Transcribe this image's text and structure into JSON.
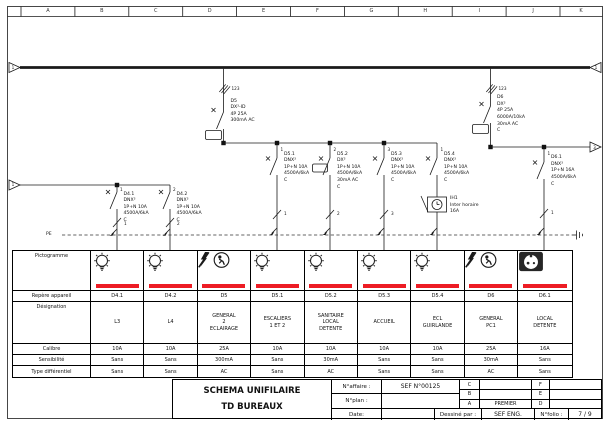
{
  "sheet": {
    "grid_letters": [
      "A",
      "B",
      "C",
      "D",
      "E",
      "F",
      "G",
      "H",
      "I",
      "J",
      "K"
    ],
    "link_markers": {
      "top_left": "1",
      "top_right": "1",
      "mid_left": "1",
      "mid_right": "3"
    },
    "pe_label": "PE"
  },
  "schematic": {
    "d5": {
      "phases": "123",
      "label": "D5\nDX³-ID\n4P 25A\n300mA AC"
    },
    "d6": {
      "phases": "123",
      "label": "D6\nDX³\n4P 25A\n6000A/10kA\n30mA AC\nC"
    },
    "d4_1": {
      "phase": "1",
      "label": "D4.1\nDNX³\n1P+N 10A\n4500A/6kA\nC",
      "circuit": "1"
    },
    "d4_2": {
      "phase": "2",
      "label": "D4.2\nDNX³\n1P+N 10A\n4500A/6kA\nC",
      "circuit": "2"
    },
    "d5_1": {
      "phase": "1",
      "label": "D5.1\nDNX³\n1P+N 10A\n4500A/6kA\nC",
      "circuit": "1"
    },
    "d5_2": {
      "phase": "2",
      "label": "D5.2\nDX³\n1P+N 10A\n4500A/6kA\n30mA AC\nC",
      "circuit": "2"
    },
    "d5_3": {
      "phase": "3",
      "label": "D5.3\nDNX³\n1P+N 10A\n4500A/6kA\nC",
      "circuit": "3"
    },
    "d5_4": {
      "phase": "1",
      "label": "D5.4\nDNX³\n1P+N 10A\n4500A/6kA\nC",
      "circuit": ""
    },
    "d6_1": {
      "phase": "1",
      "label": "D6.1\nDNX³\n1P+N 16A\n4500A/6kA\nC",
      "circuit": "1"
    },
    "ih1": {
      "label": "IH1\nInter horaire\n16A"
    }
  },
  "table": {
    "row_labels": [
      "Pictogramme",
      "Repère appareil",
      "Désignation",
      "Calibre",
      "Sensibilité",
      "Type différentiel"
    ],
    "columns": [
      {
        "picto": "lamp",
        "repere": "D4.1",
        "designation": "L3",
        "calibre": "10A",
        "sensibilite": "Sans",
        "type_diff": "Sans"
      },
      {
        "picto": "lamp",
        "repere": "D4.2",
        "designation": "L4",
        "calibre": "10A",
        "sensibilite": "Sans",
        "type_diff": "Sans"
      },
      {
        "picto": "flash-person",
        "repere": "D5",
        "designation": "GENERAL\n2\nECLAIRAGE",
        "calibre": "25A",
        "sensibilite": "300mA",
        "type_diff": "AC"
      },
      {
        "picto": "lamp",
        "repere": "D5.1",
        "designation": "ESCALIERS\n1 ET 2",
        "calibre": "10A",
        "sensibilite": "Sans",
        "type_diff": "Sans"
      },
      {
        "picto": "lamp",
        "repere": "D5.2",
        "designation": "SANITAIRE\nLOCAL\nDETENTE",
        "calibre": "10A",
        "sensibilite": "30mA",
        "type_diff": "AC"
      },
      {
        "picto": "lamp",
        "repere": "D5.3",
        "designation": "ACCUEIL",
        "calibre": "10A",
        "sensibilite": "Sans",
        "type_diff": "Sans"
      },
      {
        "picto": "lamp",
        "repere": "D5.4",
        "designation": "ECL\nGUIRLANDE",
        "calibre": "10A",
        "sensibilite": "Sans",
        "type_diff": "Sans"
      },
      {
        "picto": "flash-person",
        "repere": "D6",
        "designation": "GENERAL\nPC1",
        "calibre": "25A",
        "sensibilite": "30mA",
        "type_diff": "AC"
      },
      {
        "picto": "socket",
        "repere": "D6.1",
        "designation": "LOCAL\nDETENTE",
        "calibre": "16A",
        "sensibilite": "Sans",
        "type_diff": "Sans"
      }
    ]
  },
  "titleblock": {
    "title_line1": "SCHEMA UNIFILAIRE",
    "title_line2": "TD BUREAUX",
    "affaire_label": "N°affaire :",
    "affaire_value": "SEF N°00125",
    "plan_label": "N°plan :",
    "plan_value": "",
    "date_label": "Date:",
    "date_value": "",
    "dessine_label": "Dessiné par :",
    "dessine_value": "SEF ENG.",
    "folio_label": "N°folio :",
    "folio_value": "7 / 9",
    "revisions": [
      {
        "letter": "C",
        "value": "",
        "letter2": "F",
        "value2": ""
      },
      {
        "letter": "B",
        "value": "",
        "letter2": "E",
        "value2": ""
      },
      {
        "letter": "A",
        "value": "PREMIER",
        "letter2": "D",
        "value2": ""
      }
    ]
  },
  "colors": {
    "accent_red": "#ED1C24",
    "line": "#1a1a1a"
  }
}
